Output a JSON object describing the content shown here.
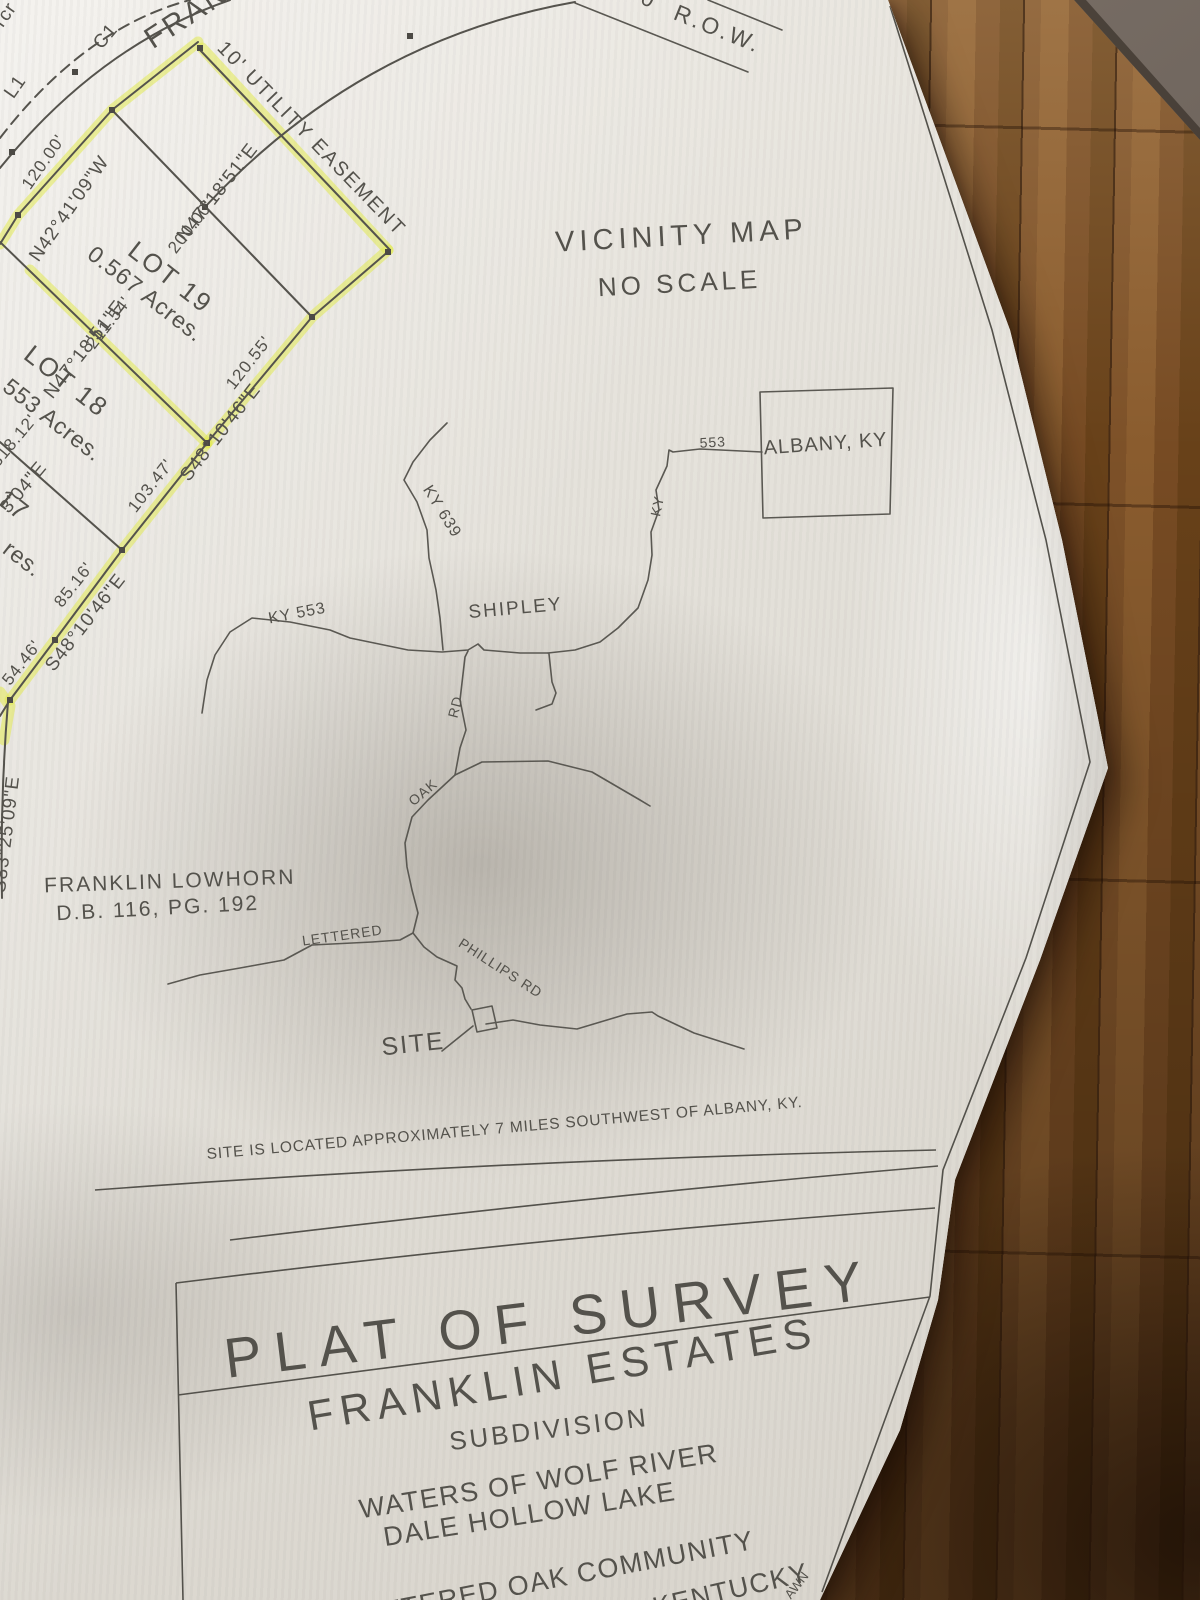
{
  "plat": {
    "corner_fragment": "rcr",
    "l1": "L1",
    "c1": "C1",
    "street_fragment": "FRAN",
    "row_prefix": "0",
    "row": "R.O.W.",
    "easement": "10' UTILITY EASEMENT",
    "dim_120": "120.00'",
    "brg_n42": "N42°41'09\"W",
    "brg_n47_a": "N47°18'51\"E",
    "dim_200": "200.00'",
    "lot19_name": "LOT 19",
    "lot19_area": "0.567 Acres.",
    "dim_211": "211.54'",
    "brg_n47_b": "N47°18'51\"E",
    "lot18_name": "LOT 18",
    "lot18_area": "553 Acres.",
    "dim_318": "318.12'",
    "brg_fragment": "3'04\"E",
    "lot17_fragment": "17",
    "acres_fragment": "res.",
    "dim_120_55": "120.55'",
    "brg_s48_a": "S48°10'46\"E",
    "dim_103": "103.47'",
    "dim_85": "85.16'",
    "brg_s48_b": "S48°10'46\"E",
    "dim_54": "54.46'",
    "brg_s83": "S83°25'09\"E",
    "owner_line1": "FRANKLIN LOWHORN",
    "owner_line2": "D.B. 116, PG. 192"
  },
  "vicinity": {
    "title": "VICINITY MAP",
    "scale": "NO SCALE",
    "ky639": "KY 639",
    "ky553": "KY 553",
    "shipley": "SHIPLEY",
    "route553": "553",
    "ky": "KY",
    "albany": "ALBANY, KY",
    "rd": "RD",
    "oak": "OAK",
    "lettered": "LETTERED",
    "phillips": "PHILLIPS RD",
    "site": "SITE",
    "note": "SITE IS LOCATED APPROXIMATELY 7 MILES SOUTHWEST OF ALBANY, KY."
  },
  "title_block": {
    "title": "PLAT OF SURVEY",
    "name": "FRANKLIN ESTATES",
    "type": "SUBDIVISION",
    "waters_1": "WATERS OF WOLF RIVER",
    "waters_2": "DALE HOLLOW LAKE",
    "community": "LETTERED OAK COMMUNITY",
    "county_fragment": "NTY KENTUCKY",
    "edge_fragment": "AWN"
  },
  "colors": {
    "highlight": "#e2ea52",
    "ink": "#55534d",
    "paper": "#e7e4dd",
    "floor": "#754a22"
  }
}
